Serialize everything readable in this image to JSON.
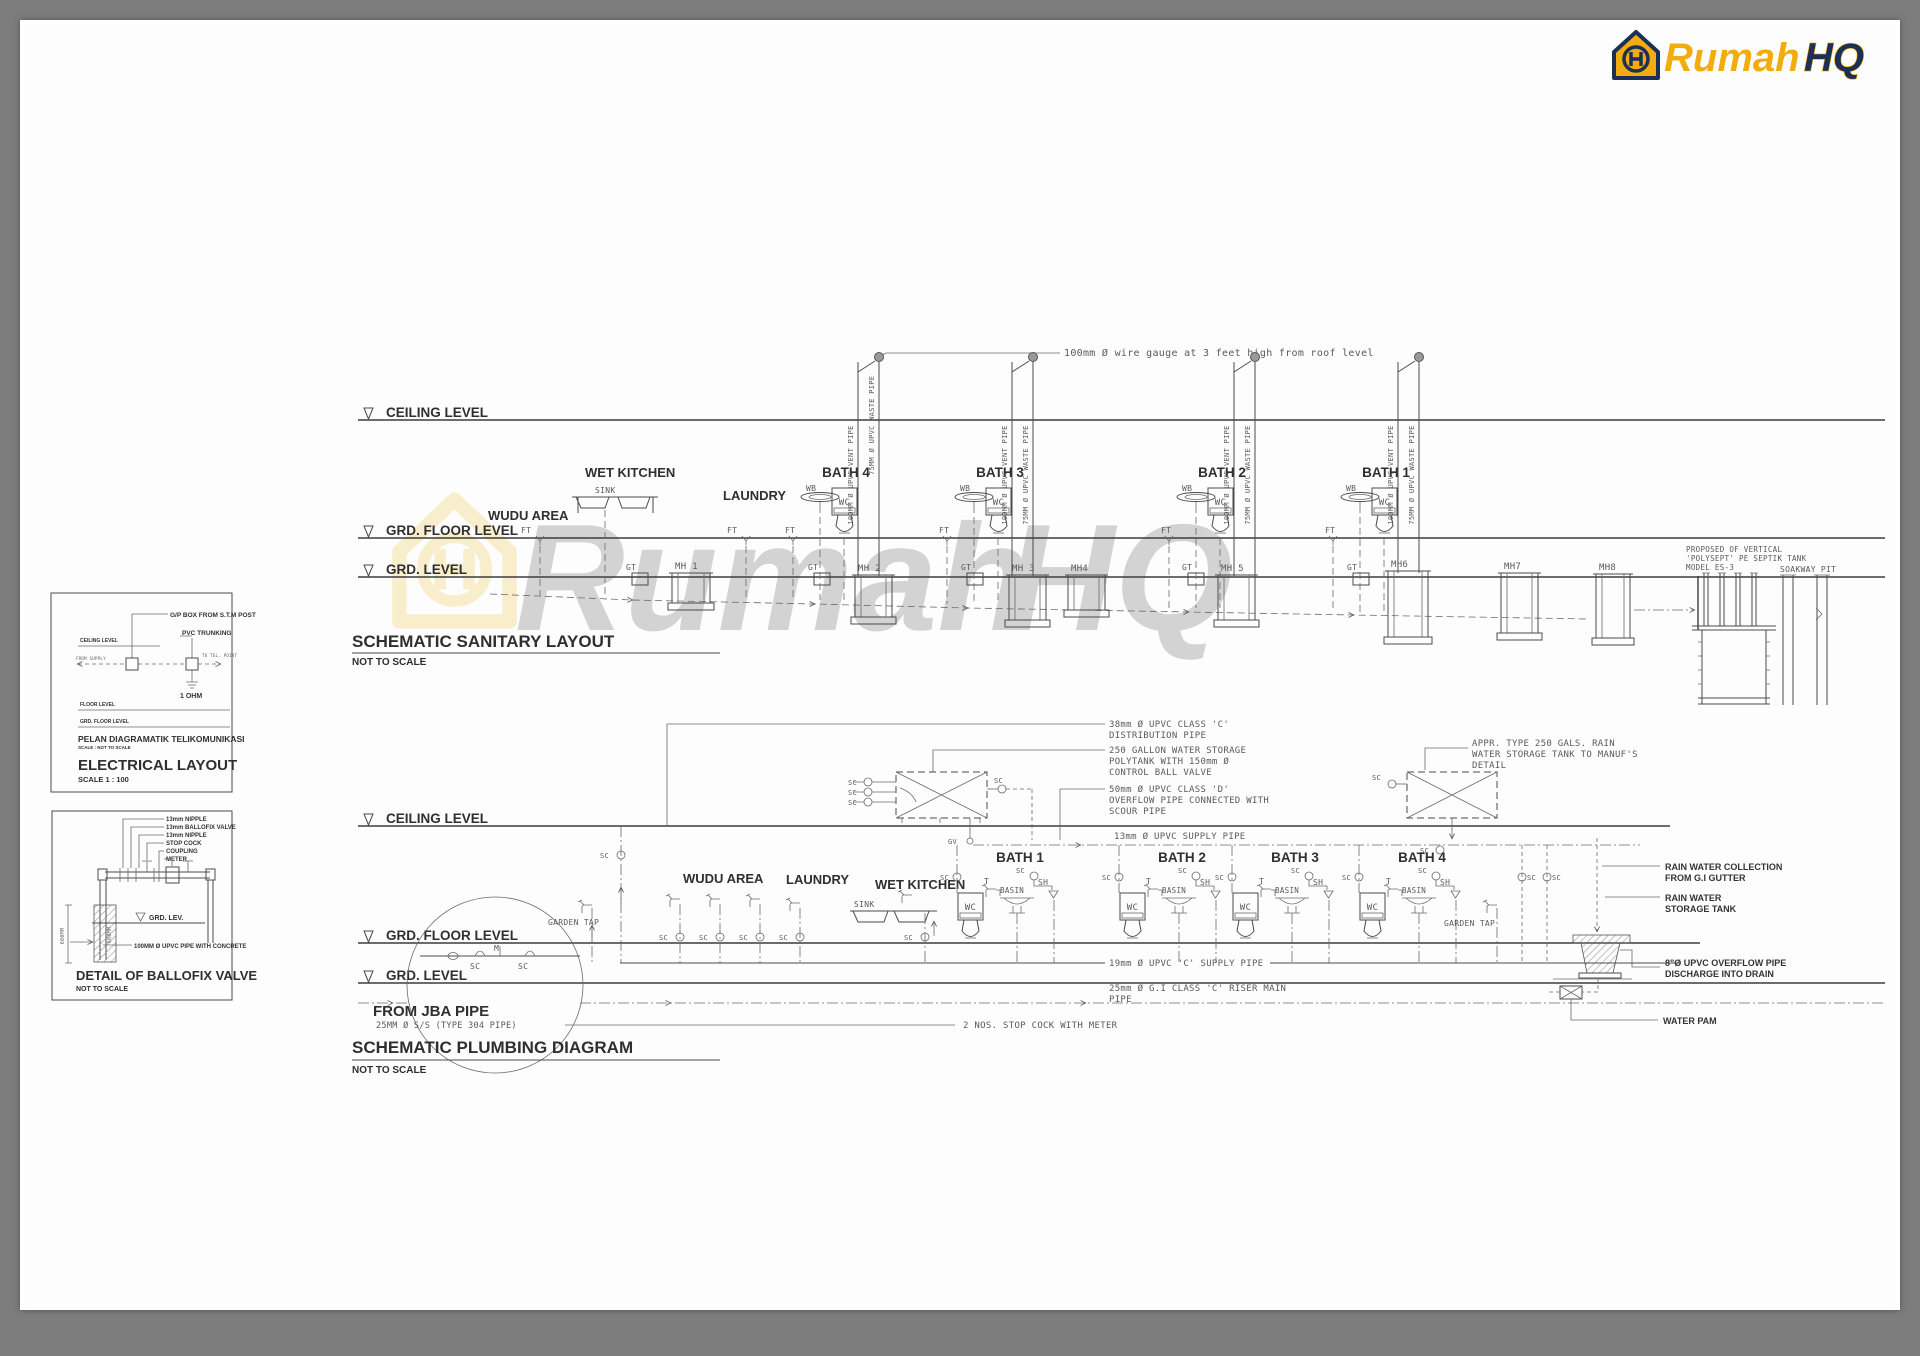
{
  "colors": {
    "paper": "#fdfdfd",
    "frame_gray": "#7d7d7d",
    "line": "#4a4a4a",
    "logo_yellow": "#f3ac0e",
    "logo_navy": "#1c2f55",
    "watermark_yellow": "#f0b90f",
    "watermark_gray": "#b5b5b5"
  },
  "logo": {
    "word1": "Rumah",
    "word2": "HQ",
    "monogram": "H"
  },
  "watermark": {
    "word1": "Rumah",
    "word2": "HQ"
  },
  "electrical": {
    "gp_box": "G/P BOX FROM  S.T.M  POST",
    "pvc_trunking": "PVC TRUNKING",
    "ceiling_level": "CEILING  LEVEL",
    "from_label": "FROM SUPPLY",
    "to_label": "TO TEL. POINT",
    "ohm": "1 OHM",
    "floor_level": "FLOOR  LEVEL",
    "grd_floor_level": "GRD. FLOOR  LEVEL",
    "subtitle": "PELAN DIAGRAMATIK TELIKOMUNIKASI",
    "subtitle_scale": "SCALE  : NOT TO SCALE",
    "title": "ELECTRICAL LAYOUT",
    "scale": "SCALE 1 : 100"
  },
  "ballofix": {
    "callouts": [
      "13mm NIPPLE",
      "13mm BALLOFIX VALVE",
      "13mm NIPPLE",
      "STOP COCK",
      "COUPLING",
      "METER"
    ],
    "grd_lev": "GRD. LEV.",
    "dim_left": "600MM",
    "dim_inner": "600MM",
    "pipe_note": "100MM Ø UPVC PIPE WITH CONCRETE",
    "title": "DETAIL OF BALLOFIX VALVE",
    "scale": "NOT TO SCALE"
  },
  "sanitary": {
    "title": "SCHEMATIC SANITARY LAYOUT",
    "scale": "NOT TO SCALE",
    "ceiling": "CEILING LEVEL",
    "floor": "GRD.  FLOOR LEVEL",
    "grd": "GRD. LEVEL",
    "wire_note": "100mm Ø wire gauge at 3 feet high from roof level",
    "wudu": "WUDU AREA",
    "wet_kitchen": "WET KITCHEN",
    "sink": "SINK",
    "laundry": "LAUNDRY",
    "baths": [
      "BATH 4",
      "BATH 3",
      "BATH 2",
      "BATH 1"
    ],
    "wb": "WB",
    "wc": "WC",
    "ft": "FT",
    "gt": "GT",
    "vent_pipe": "100MM Ø UPVC VENT PIPE",
    "waste_pipe": "75MM Ø UPVC WASTE PIPE",
    "manholes": [
      "MH 1",
      "MH 2",
      "MH 3",
      "MH4",
      "MH 5",
      "MH6",
      "MH7",
      "MH8"
    ],
    "septic": {
      "l1": "PROPOSED  OF  VERTICAL",
      "l2": "'POLYSEPT'  PE  SEPTIK  TANK",
      "l3": "MODEL  ES-3"
    },
    "soakway": "SOAKWAY  PIT"
  },
  "plumbing": {
    "title": "SCHEMATIC PLUMBING DIAGRAM",
    "scale": "NOT TO SCALE",
    "ceiling": "CEILING LEVEL",
    "floor": "GRD.  FLOOR LEVEL",
    "grd": "GRD. LEVEL",
    "ann_dist": {
      "l1": "38mm  Ø  UPVC  CLASS  'C'",
      "l2": "DISTRIBUTION  PIPE"
    },
    "ann_tank": {
      "l1": "250  GALLON  WATER  STORAGE",
      "l2": "POLYTANK  WITH  150mm  Ø",
      "l3": "CONTROL  BALL  VALVE"
    },
    "ann_overflow": {
      "l1": "50mm  Ø  UPVC  CLASS  'D'",
      "l2": "OVERFLOW  PIPE  CONNECTED  WITH",
      "l3": "SCOUR  PIPE"
    },
    "ann_supply13": "13mm Ø UPVC SUPPLY PIPE",
    "ann_rain_tank": {
      "l1": "APPR.      TYPE  250  GALS.  RAIN",
      "l2": "WATER  STORAGE  TANK  TO  MANUF'S",
      "l3": "DETAIL"
    },
    "ann_supply19": "19mm  Ø  UPVC  'C'  SUPPLY  PIPE",
    "ann_riser": {
      "l1": "25mm  Ø  G.I  CLASS  'C'  RISER  MAIN",
      "l2": "PIPE"
    },
    "ann_stopcock": "2  NOS.  STOP  COCK  WITH  METER",
    "garden_tap": "GARDEN  TAP",
    "wudu": "WUDU AREA",
    "laundry": "LAUNDRY",
    "wet_kitchen": "WET KITCHEN",
    "sink": "SINK",
    "baths": [
      "BATH 1",
      "BATH 2",
      "BATH 3",
      "BATH 4"
    ],
    "sym": {
      "sc": "SC",
      "gv": "GV",
      "t": "T",
      "basin": "BASIN",
      "sh": "SH",
      "wc": "WC",
      "m": "M"
    },
    "right_labels": {
      "collect": {
        "l1": "RAIN WATER COLLECTION",
        "l2": "FROM G.I GUTTER"
      },
      "storage": {
        "l1": "RAIN WATER",
        "l2": "STORAGE TANK"
      },
      "overflow": {
        "l1": "8\"Ø UPVC OVERFLOW PIPE",
        "l2": "DISCHARGE INTO DRAIN"
      },
      "pump": "WATER PAM"
    },
    "from_jba": "FROM JBA PIPE",
    "jba_spec": "25MM Ø S/S (TYPE 304 PIPE)"
  }
}
